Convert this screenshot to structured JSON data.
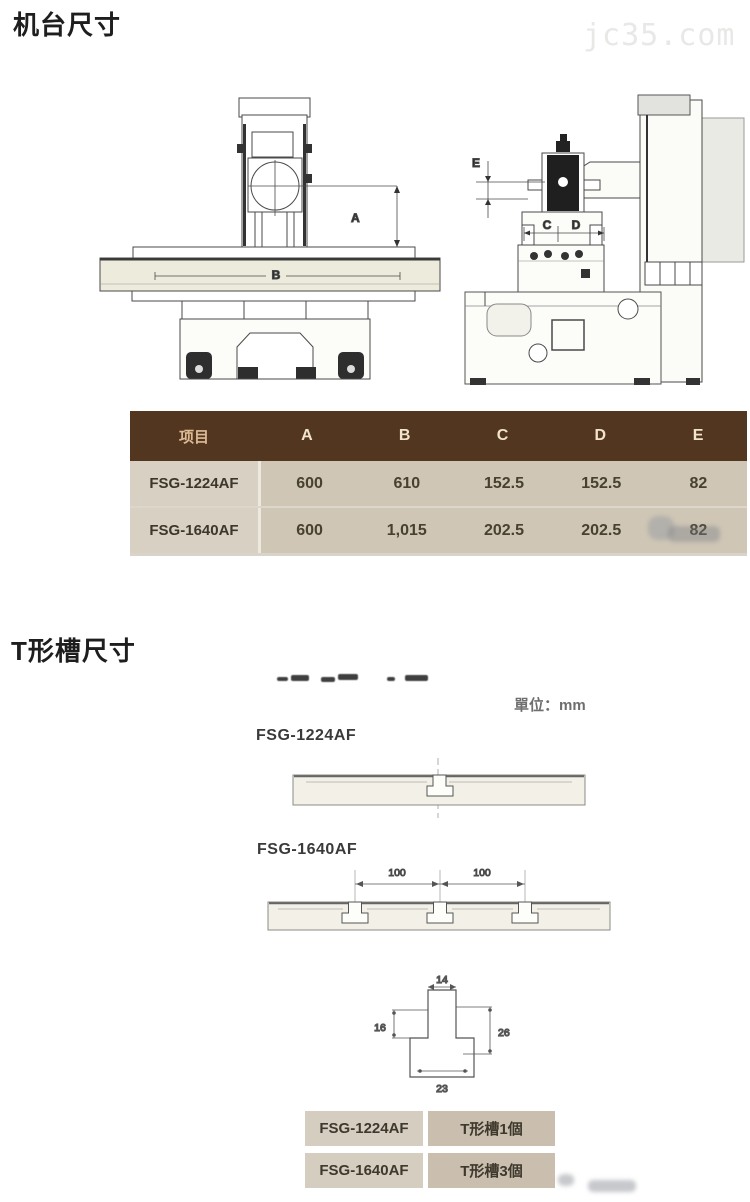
{
  "machine_section": {
    "title": "机台尺寸",
    "watermark": "jc35.com",
    "front_view": {
      "dim_a": "A",
      "dim_b": "B"
    },
    "side_view": {
      "dim_c": "C",
      "dim_d": "D",
      "dim_e": "E"
    },
    "table": {
      "headers": [
        "项目",
        "A",
        "B",
        "C",
        "D",
        "E"
      ],
      "rows": [
        {
          "model": "FSG-1224AF",
          "values": [
            "600",
            "610",
            "152.5",
            "152.5",
            "82"
          ]
        },
        {
          "model": "FSG-1640AF",
          "values": [
            "600",
            "1,015",
            "202.5",
            "202.5",
            "82"
          ]
        }
      ]
    }
  },
  "tslot_section": {
    "title": "T形槽尺寸",
    "unit_label": "單位：mm",
    "profiles": [
      {
        "label": "FSG-1224AF",
        "slot_count_note": "1 slot"
      },
      {
        "label": "FSG-1640AF",
        "slot_spacing": [
          "100",
          "100"
        ],
        "slot_count_note": "3 slots"
      }
    ],
    "detail_dims": {
      "top_width": "14",
      "left_depth": "16",
      "right_depth": "26",
      "bottom_width": "23"
    },
    "table": {
      "rows": [
        {
          "model": "FSG-1224AF",
          "slots": "T形槽1個"
        },
        {
          "model": "FSG-1640AF",
          "slots": "T形槽3個"
        }
      ]
    }
  },
  "colors": {
    "table_header_bg": "#533620",
    "table_header_text": "#f1e4cc",
    "row_model_bg": "#d7d0c3",
    "row_value_bg": "#cfc6b6",
    "small_table_model_bg": "#d5cdbf",
    "small_table_value_bg": "#cabfaf",
    "watermark_text": "#e8e8e6",
    "drawing_fill": "#edebdc"
  }
}
